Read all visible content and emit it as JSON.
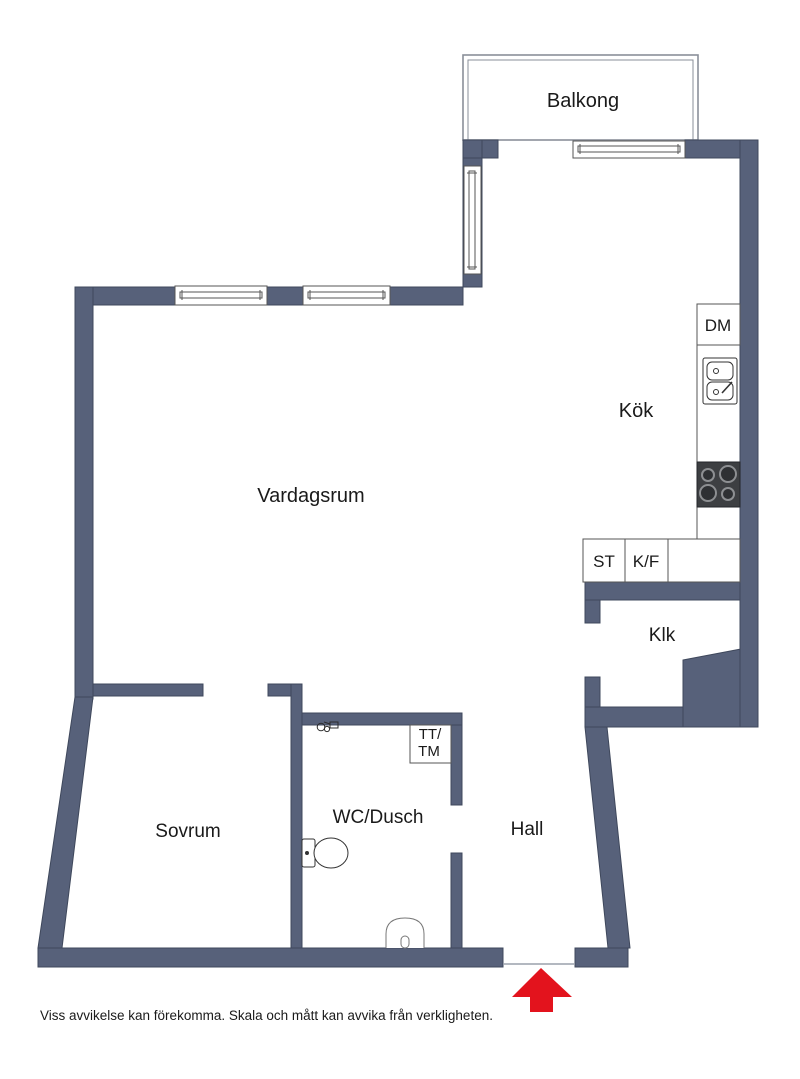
{
  "floor_plan": {
    "rooms": {
      "balcony": "Balkong",
      "kitchen": "Kök",
      "living_room": "Vardagsrum",
      "closet": "Klk",
      "bedroom": "Sovrum",
      "bathroom": "WC/Dusch",
      "hall": "Hall"
    },
    "appliances": {
      "dishwasher": "DM",
      "cleaning_cabinet": "ST",
      "fridge_freezer": "K/F",
      "dryer_washer_line1": "TT/",
      "dryer_washer_line2": "TM"
    },
    "disclaimer": "Viss avvikelse kan förekomma. Skala och mått kan avvika från verkligheten.",
    "colors": {
      "wall": "#57617a",
      "wall_stroke": "#3f485c",
      "arrow": "#e3131d",
      "fixture_line": "#555555",
      "balcony_line": "#8a8f99"
    }
  }
}
